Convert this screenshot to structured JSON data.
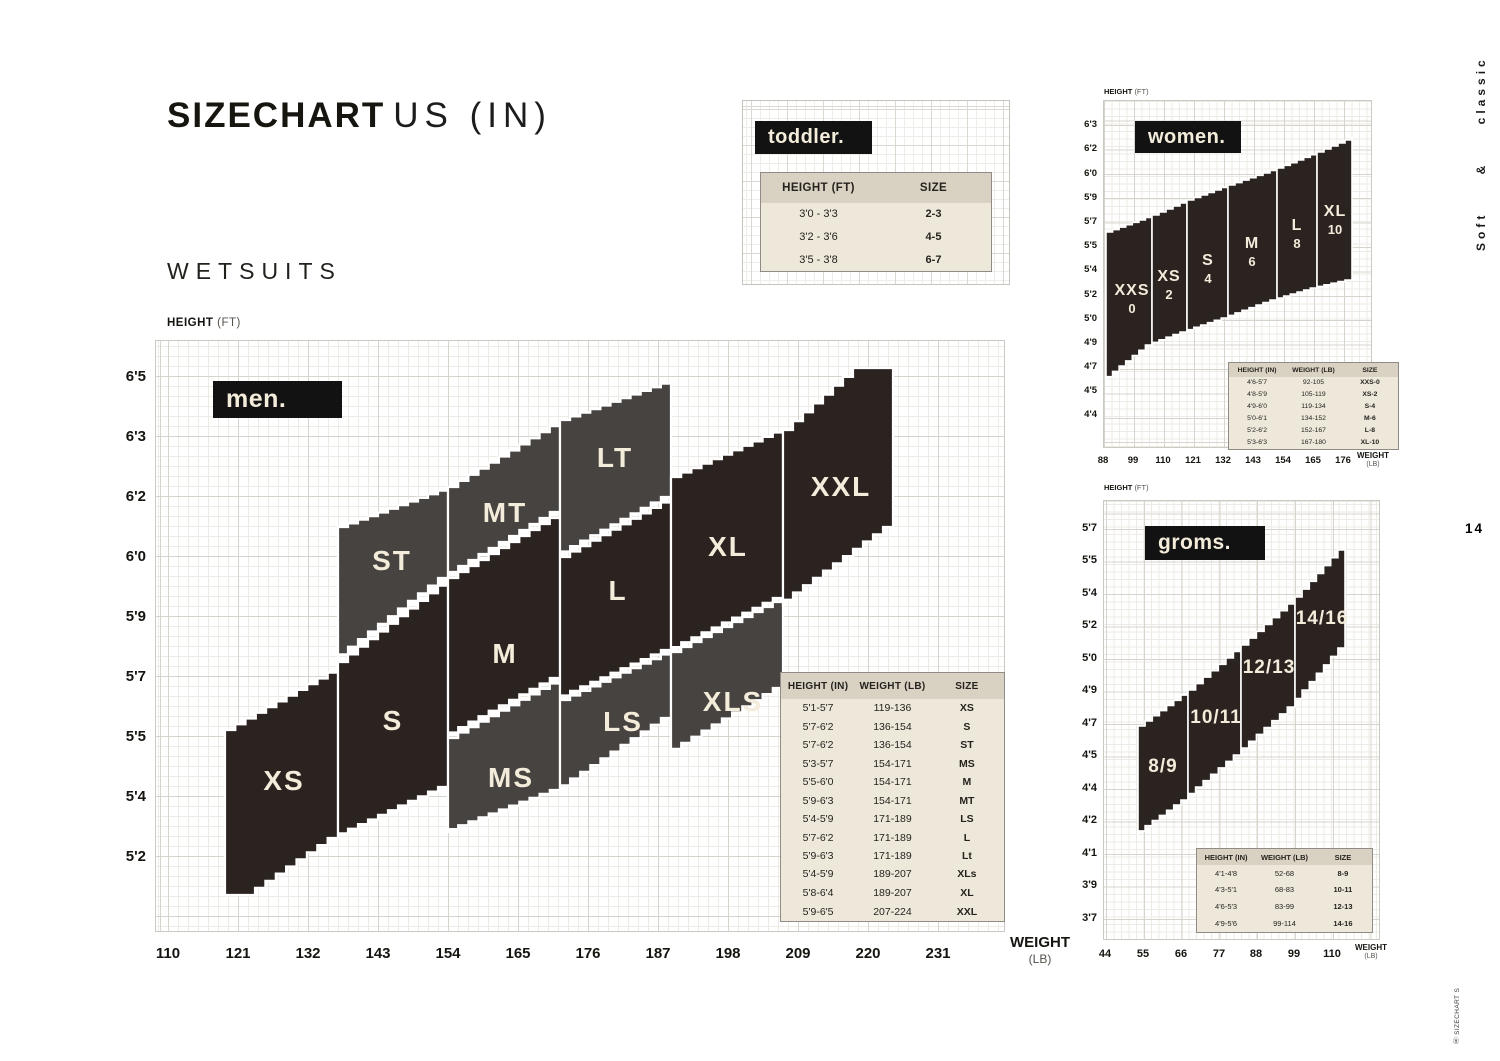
{
  "header": {
    "title_bold": "SIZECHART",
    "title_light": "US (IN)",
    "subtitle": "WETSUITS"
  },
  "side": {
    "vertical_text": "Soft & classic",
    "page_number": "14",
    "footer_vertical_text": "Ⓡ SIZECHART S"
  },
  "colors": {
    "band_dark": "#2b2320",
    "band_gray": "#474340",
    "label_cream": "#f3ecda",
    "box_black": "#121212",
    "table_bg": "#eee8db",
    "table_header_bg": "#d9d2c3"
  },
  "chart_data": [
    {
      "id": "men",
      "type": "area",
      "title": "men.",
      "xlabel": "WEIGHT (LB)",
      "ylabel": "HEIGHT (FT)",
      "xlabel_bold": "WEIGHT",
      "xlabel_unit": "(LB)",
      "ylabel_bold": "HEIGHT",
      "ylabel_unit": "(FT)",
      "y_ticks": [
        "6'5",
        "6'3",
        "6'2",
        "6'0",
        "5'9",
        "5'7",
        "5'5",
        "5'4",
        "5'2"
      ],
      "x_ticks": [
        "110",
        "121",
        "132",
        "143",
        "154",
        "165",
        "176",
        "187",
        "198",
        "209",
        "220",
        "231"
      ],
      "regions": [
        {
          "size": "XS",
          "shade": "dark",
          "height_in": "5'1-5'7",
          "weight_lb": "119-136",
          "poly": [
            [
              225,
              730
            ],
            [
              338,
              667
            ],
            [
              338,
              838
            ],
            [
              255,
              895
            ],
            [
              225,
              895
            ]
          ],
          "label_xy": [
            284,
            790
          ]
        },
        {
          "size": "S",
          "shade": "dark",
          "height_in": "5'7-6'2",
          "weight_lb": "136-154",
          "poly": [
            [
              338,
              662
            ],
            [
              448,
              578
            ],
            [
              448,
              787
            ],
            [
              338,
              838
            ]
          ],
          "label_xy": [
            393,
            730
          ]
        },
        {
          "size": "ST",
          "shade": "gray",
          "height_in": "5'7-6'2",
          "weight_lb": "136-154",
          "poly": [
            [
              338,
              527
            ],
            [
              448,
              487
            ],
            [
              448,
              578
            ],
            [
              338,
              662
            ]
          ],
          "label_xy": [
            392,
            570
          ]
        },
        {
          "size": "MT",
          "shade": "gray",
          "height_in": "5'9-6'3",
          "weight_lb": "154-171",
          "poly": [
            [
              448,
              487
            ],
            [
              560,
              420
            ],
            [
              560,
              512
            ],
            [
              448,
              578
            ]
          ],
          "label_xy": [
            505,
            522
          ]
        },
        {
          "size": "M",
          "shade": "dark",
          "height_in": "5'5-6'0",
          "weight_lb": "154-171",
          "poly": [
            [
              448,
              578
            ],
            [
              560,
              512
            ],
            [
              560,
              678
            ],
            [
              448,
              738
            ]
          ],
          "label_xy": [
            505,
            663
          ]
        },
        {
          "size": "MS",
          "shade": "gray",
          "height_in": "5'3-5'7",
          "weight_lb": "154-171",
          "poly": [
            [
              448,
              738
            ],
            [
              560,
              678
            ],
            [
              560,
              790
            ],
            [
              448,
              833
            ]
          ],
          "label_xy": [
            511,
            787
          ]
        },
        {
          "size": "LT",
          "shade": "gray",
          "height_in": "5'9-6'3",
          "weight_lb": "171-189",
          "poly": [
            [
              560,
              420
            ],
            [
              671,
              380
            ],
            [
              671,
              497
            ],
            [
              560,
              557
            ]
          ],
          "label_xy": [
            615,
            467
          ]
        },
        {
          "size": "L",
          "shade": "dark",
          "height_in": "5'7-6'2",
          "weight_lb": "171-189",
          "poly": [
            [
              560,
              557
            ],
            [
              671,
              497
            ],
            [
              671,
              650
            ],
            [
              560,
              700
            ]
          ],
          "label_xy": [
            618,
            600
          ]
        },
        {
          "size": "LS",
          "shade": "gray",
          "height_in": "5'4-5'9",
          "weight_lb": "171-189",
          "poly": [
            [
              560,
              700
            ],
            [
              671,
              650
            ],
            [
              671,
              718
            ],
            [
              560,
              792
            ]
          ],
          "label_xy": [
            623,
            731
          ]
        },
        {
          "size": "XL",
          "shade": "dark",
          "height_in": "5'8-6'4",
          "weight_lb": "189-207",
          "poly": [
            [
              671,
              477
            ],
            [
              783,
              428
            ],
            [
              783,
              598
            ],
            [
              671,
              652
            ]
          ],
          "label_xy": [
            728,
            556
          ]
        },
        {
          "size": "XLS",
          "shade": "gray",
          "height_in": "5'4-5'9",
          "weight_lb": "189-207",
          "poly": [
            [
              671,
              652
            ],
            [
              783,
              597
            ],
            [
              783,
              688
            ],
            [
              671,
              755
            ]
          ],
          "label_xy": [
            733,
            711
          ]
        },
        {
          "size": "XXL",
          "shade": "dark",
          "height_in": "5'9-6'5",
          "weight_lb": "207-224",
          "poly": [
            [
              783,
              430
            ],
            [
              853,
              368
            ],
            [
              893,
              368
            ],
            [
              893,
              527
            ],
            [
              783,
              607
            ]
          ],
          "label_xy": [
            841,
            496
          ]
        }
      ],
      "table": {
        "headers": [
          "HEIGHT (IN)",
          "WEIGHT (LB)",
          "SIZE"
        ],
        "rows": [
          [
            "5'1-5'7",
            "119-136",
            "XS"
          ],
          [
            "5'7-6'2",
            "136-154",
            "S"
          ],
          [
            "5'7-6'2",
            "136-154",
            "ST"
          ],
          [
            "5'3-5'7",
            "154-171",
            "MS"
          ],
          [
            "5'5-6'0",
            "154-171",
            "M"
          ],
          [
            "5'9-6'3",
            "154-171",
            "MT"
          ],
          [
            "5'4-5'9",
            "171-189",
            "LS"
          ],
          [
            "5'7-6'2",
            "171-189",
            "L"
          ],
          [
            "5'9-6'3",
            "171-189",
            "Lt"
          ],
          [
            "5'4-5'9",
            "189-207",
            "XLs"
          ],
          [
            "5'8-6'4",
            "189-207",
            "XL"
          ],
          [
            "5'9-6'5",
            "207-224",
            "XXL"
          ]
        ]
      }
    },
    {
      "id": "women",
      "type": "area",
      "title": "women.",
      "xlabel": "WEIGHT (LB)",
      "ylabel": "HEIGHT (FT)",
      "xlabel_bold": "WEIGHT",
      "xlabel_unit": "(LB)",
      "ylabel_bold": "HEIGHT",
      "ylabel_unit": "(FT)",
      "y_ticks": [
        "6'3",
        "6'2",
        "6'0",
        "5'9",
        "5'7",
        "5'5",
        "5'4",
        "5'2",
        "5'0",
        "4'9",
        "4'7",
        "4'5",
        "4'4"
      ],
      "x_ticks": [
        "88",
        "99",
        "110",
        "121",
        "132",
        "143",
        "154",
        "165",
        "176"
      ],
      "regions": [
        {
          "size": "XXS",
          "sub": "0",
          "shade": "dark",
          "height_in": "4'6-5'7",
          "weight_lb": "92-105",
          "poly": [
            [
              1106,
              232
            ],
            [
              1152,
              215
            ],
            [
              1152,
              345
            ],
            [
              1106,
              382
            ]
          ],
          "label_xy": [
            1132,
            295
          ]
        },
        {
          "size": "XS",
          "sub": "2",
          "shade": "dark",
          "height_in": "4'8-5'9",
          "weight_lb": "105-119",
          "poly": [
            [
              1152,
              215
            ],
            [
              1187,
              200
            ],
            [
              1187,
              332
            ],
            [
              1152,
              345
            ]
          ],
          "label_xy": [
            1169,
            281
          ]
        },
        {
          "size": "S",
          "sub": "4",
          "shade": "dark",
          "height_in": "4'9-6'0",
          "weight_lb": "119-134",
          "poly": [
            [
              1187,
              200
            ],
            [
              1228,
              185
            ],
            [
              1228,
              318
            ],
            [
              1187,
              332
            ]
          ],
          "label_xy": [
            1208,
            265
          ]
        },
        {
          "size": "M",
          "sub": "6",
          "shade": "dark",
          "height_in": "5'0-6'1",
          "weight_lb": "134-152",
          "poly": [
            [
              1228,
              185
            ],
            [
              1277,
              168
            ],
            [
              1277,
              300
            ],
            [
              1228,
              318
            ]
          ],
          "label_xy": [
            1252,
            248
          ]
        },
        {
          "size": "L",
          "sub": "8",
          "shade": "dark",
          "height_in": "5'2-6'2",
          "weight_lb": "152-167",
          "poly": [
            [
              1277,
              168
            ],
            [
              1317,
              152
            ],
            [
              1317,
              288
            ],
            [
              1277,
              300
            ]
          ],
          "label_xy": [
            1297,
            230
          ]
        },
        {
          "size": "XL",
          "sub": "10",
          "shade": "dark",
          "height_in": "5'3-6'3",
          "weight_lb": "167-180",
          "poly": [
            [
              1317,
              152
            ],
            [
              1352,
              137
            ],
            [
              1352,
              280
            ],
            [
              1317,
              288
            ]
          ],
          "label_xy": [
            1335,
            216
          ]
        }
      ],
      "table": {
        "headers": [
          "HEIGHT (IN)",
          "WEIGHT (LB)",
          "SIZE"
        ],
        "rows": [
          [
            "4'6-5'7",
            "92-105",
            "XXS-0"
          ],
          [
            "4'8-5'9",
            "105-119",
            "XS-2"
          ],
          [
            "4'9-6'0",
            "119-134",
            "S-4"
          ],
          [
            "5'0-6'1",
            "134-152",
            "M-6"
          ],
          [
            "5'2-6'2",
            "152-167",
            "L-8"
          ],
          [
            "5'3-6'3",
            "167-180",
            "XL-10"
          ]
        ]
      }
    },
    {
      "id": "groms",
      "type": "area",
      "title": "groms.",
      "xlabel": "WEIGHT (LB)",
      "ylabel": "HEIGHT (FT)",
      "xlabel_bold": "WEIGHT",
      "xlabel_unit": "(LB)",
      "ylabel_bold": "HEIGHT",
      "ylabel_unit": "(FT)",
      "y_ticks": [
        "5'7",
        "5'5",
        "5'4",
        "5'2",
        "5'0",
        "4'9",
        "4'7",
        "4'5",
        "4'4",
        "4'2",
        "4'1",
        "3'9",
        "3'7"
      ],
      "x_ticks": [
        "44",
        "55",
        "66",
        "77",
        "88",
        "99",
        "110"
      ],
      "regions": [
        {
          "size": "8/9",
          "shade": "dark",
          "height_in": "4'1-4'8",
          "weight_lb": "52-68",
          "poly": [
            [
              1138,
              726
            ],
            [
              1188,
              690
            ],
            [
              1188,
              800
            ],
            [
              1138,
              836
            ]
          ],
          "label_xy": [
            1163,
            772
          ]
        },
        {
          "size": "10/11",
          "shade": "dark",
          "height_in": "4'3-5'1",
          "weight_lb": "68-83",
          "poly": [
            [
              1188,
              690
            ],
            [
              1241,
              645
            ],
            [
              1241,
              755
            ],
            [
              1188,
              800
            ]
          ],
          "label_xy": [
            1216,
            723
          ]
        },
        {
          "size": "12/13",
          "shade": "dark",
          "height_in": "4'6-5'3",
          "weight_lb": "83-99",
          "poly": [
            [
              1241,
              645
            ],
            [
              1295,
              597
            ],
            [
              1295,
              707
            ],
            [
              1241,
              755
            ]
          ],
          "label_xy": [
            1269,
            673
          ]
        },
        {
          "size": "14/16",
          "shade": "dark",
          "height_in": "4'9-5'6",
          "weight_lb": "99-114",
          "poly": [
            [
              1295,
              597
            ],
            [
              1345,
              542
            ],
            [
              1345,
              648
            ],
            [
              1295,
              707
            ]
          ],
          "label_xy": [
            1322,
            624
          ]
        }
      ],
      "table": {
        "headers": [
          "HEIGHT (IN)",
          "WEIGHT (LB)",
          "SIZE"
        ],
        "rows": [
          [
            "4'1-4'8",
            "52-68",
            "8-9"
          ],
          [
            "4'3-5'1",
            "68-83",
            "10-11"
          ],
          [
            "4'6-5'3",
            "83-99",
            "12-13"
          ],
          [
            "4'9-5'6",
            "99-114",
            "14-16"
          ]
        ]
      }
    },
    {
      "id": "toddler",
      "type": "table",
      "title": "toddler.",
      "table": {
        "headers": [
          "HEIGHT (FT)",
          "SIZE"
        ],
        "rows": [
          [
            "3'0 - 3'3",
            "2-3"
          ],
          [
            "3'2 - 3'6",
            "4-5"
          ],
          [
            "3'5 - 3'8",
            "6-7"
          ]
        ]
      }
    }
  ]
}
